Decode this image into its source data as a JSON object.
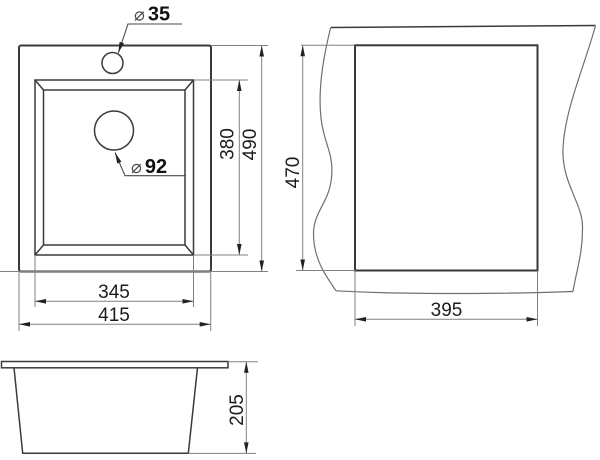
{
  "drawing_title": "sink-dimension-drawing",
  "colors": {
    "outline": "#3a3a3a",
    "dim_line": "#808080",
    "arrow": "#222222",
    "text": "#1c1c1c"
  },
  "top_view": {
    "faucet_label": {
      "symbol": "⌀",
      "value": "35"
    },
    "drain_label": {
      "symbol": "⌀",
      "value": "92"
    },
    "dims": {
      "basin_length": "380",
      "overall_length": "490",
      "basin_width": "345",
      "overall_width": "415"
    }
  },
  "cutout_view": {
    "dims": {
      "cutout_length": "470",
      "cutout_width": "395"
    }
  },
  "front_view": {
    "dims": {
      "height": "205"
    }
  }
}
